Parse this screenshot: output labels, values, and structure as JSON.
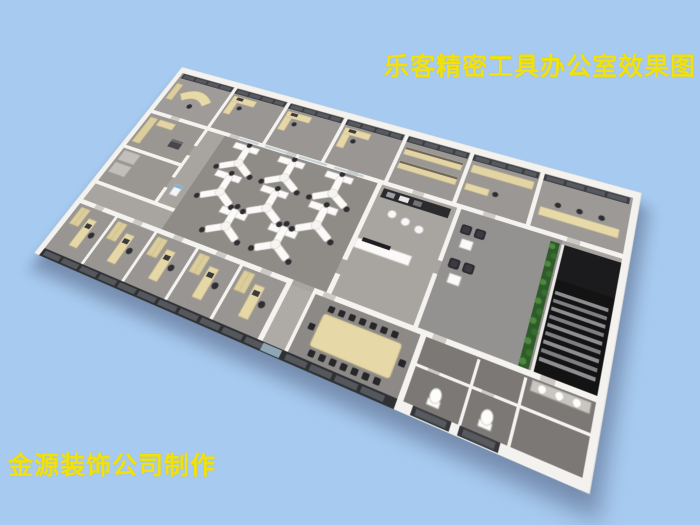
{
  "background_color": "#a7cbf0",
  "title": {
    "text": "乐客精密工具办公室效果图",
    "color": "#f0e20a"
  },
  "credit": {
    "text": "金源装饰公司制作",
    "color": "#f0e20a"
  },
  "scene": {
    "description": "bird's-eye 3D render of an office floor plan on light blue background",
    "colors": {
      "walls": "#f4f2ef",
      "corridor_floor": "#a8a5a1",
      "open_office_floor": "#8f8c88",
      "washroom_floor": "#7b7875",
      "desk_wood": "#e6d7a7",
      "workstation_white": "#fbfaf8",
      "window_glass": "#3c3e42",
      "storefront_glass": "#2f3135",
      "chair_black": "#2f2f33",
      "plant_green": "#4a8a3c",
      "stair_void": "#131313"
    },
    "counts": {
      "y_workstations": 8,
      "top_offices": 7,
      "bottom_offices": 5,
      "conference_chairs": 16,
      "lounge_armchairs": 4,
      "pantry_stools": 3,
      "toilets": 2,
      "washbasins": 3
    }
  }
}
